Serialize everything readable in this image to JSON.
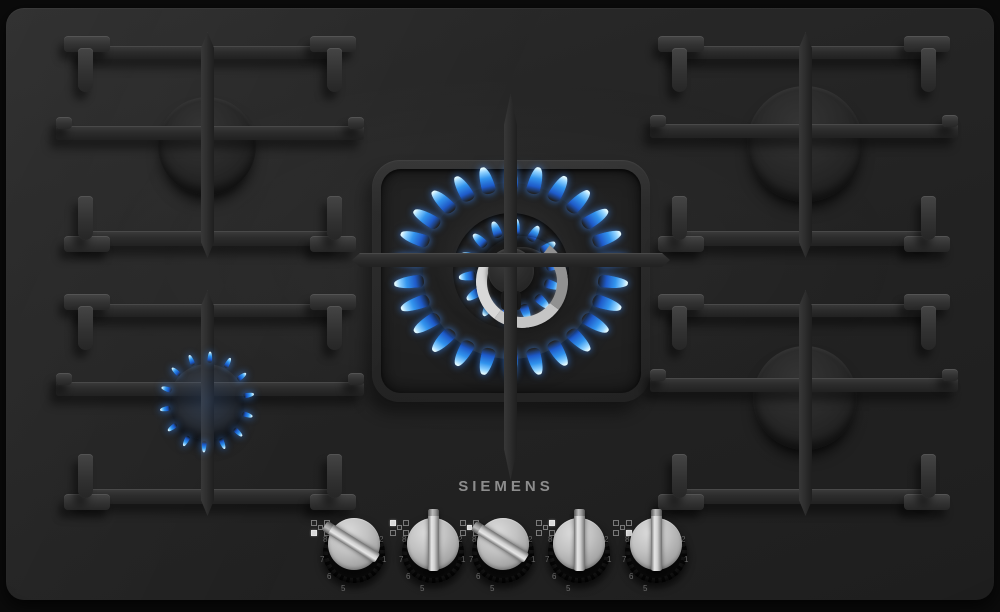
{
  "brand": {
    "logo": "SIEMENS",
    "logo_color": "#8d8d8d"
  },
  "appliance": {
    "kind": "5-burner gas hob",
    "surface": "black tempered glass"
  },
  "burners": [
    {
      "id": "back-left",
      "size": "medium",
      "state": "off",
      "grate": {
        "x": 58,
        "y": 30,
        "w": 292,
        "h": 212
      },
      "cap": {
        "cx": 143,
        "cy": 108,
        "r": 49
      }
    },
    {
      "id": "back-right",
      "size": "large",
      "state": "off",
      "grate": {
        "x": 652,
        "y": 30,
        "w": 292,
        "h": 212
      },
      "cap": {
        "cx": 147,
        "cy": 106,
        "r": 58
      }
    },
    {
      "id": "front-left",
      "size": "small",
      "state": "simmer",
      "grate": {
        "x": 58,
        "y": 288,
        "w": 292,
        "h": 212
      },
      "cap": {
        "cx": 143,
        "cy": 106,
        "r": 38
      },
      "flame": {
        "count": 14,
        "radius": 45,
        "w": 5,
        "h": 11
      }
    },
    {
      "id": "front-right",
      "size": "medium",
      "state": "off",
      "grate": {
        "x": 652,
        "y": 288,
        "w": 292,
        "h": 212
      },
      "cap": {
        "cx": 147,
        "cy": 102,
        "r": 52
      }
    },
    {
      "id": "center-wok",
      "size": "wok",
      "state": "high",
      "cap": {
        "cx": 505,
        "cy": 263
      },
      "flame": {
        "outer_count": 26,
        "outer_radius": 96,
        "outer_w": 13,
        "outer_h": 28,
        "inner_count": 14,
        "inner_radius": 44,
        "inner_w": 9,
        "inner_h": 17
      }
    }
  ],
  "knobs": [
    {
      "id": "front-left",
      "cx": 348,
      "angle_deg": -58,
      "state": "on",
      "icon_active": "bl"
    },
    {
      "id": "back-left",
      "cx": 427,
      "angle_deg": 0,
      "state": "off",
      "icon_active": "tl"
    },
    {
      "id": "center-wok",
      "cx": 497,
      "angle_deg": -58,
      "state": "on",
      "icon_active": "c"
    },
    {
      "id": "back-right",
      "cx": 573,
      "angle_deg": 0,
      "state": "off",
      "icon_active": "tr"
    },
    {
      "id": "front-right",
      "cx": 650,
      "angle_deg": 0,
      "state": "off",
      "icon_active": "br"
    }
  ],
  "dial_numbers": {
    "left": [
      "8",
      "7",
      "6",
      "5"
    ],
    "right": [
      "2",
      "1"
    ]
  },
  "colors": {
    "glass": "#222222",
    "grate": "#2c2c2c",
    "flame_base": "#1a57c8",
    "flame_mid": "#2f93ee",
    "flame_tip": "#e6fbff",
    "flame_glow": "rgba(60,140,255,0.18)",
    "knob_metal": "#c2c2c2"
  }
}
